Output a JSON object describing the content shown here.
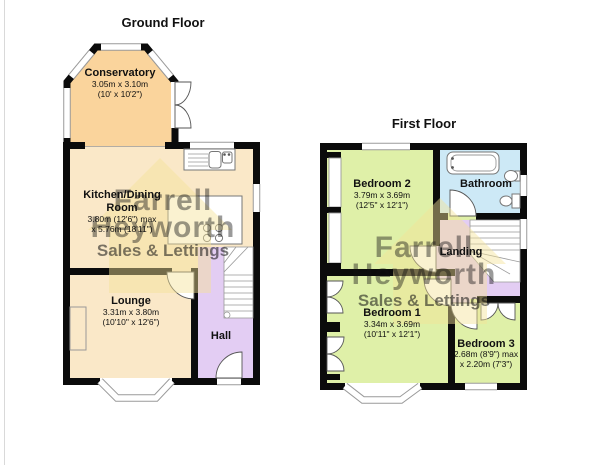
{
  "titles": {
    "ground": "Ground Floor",
    "first": "First Floor"
  },
  "watermark": {
    "name1": "Farrell",
    "name2": "Heyworth",
    "tagline": "Sales & Lettings"
  },
  "rooms": {
    "conservatory": {
      "name": "Conservatory",
      "dim_metric": "3.05m x 3.10m",
      "dim_imperial": "(10' x 10'2\")"
    },
    "kitchen": {
      "name_line1": "Kitchen/Dining",
      "name_line2": "Room",
      "dim_metric": "3.80m (12'6\") max",
      "dim_imperial": "x 5.76m (18'11\")"
    },
    "lounge": {
      "name": "Lounge",
      "dim_metric": "3.31m x 3.80m",
      "dim_imperial": "(10'10\" x 12'6\")"
    },
    "hall": {
      "name": "Hall"
    },
    "bedroom2": {
      "name": "Bedroom 2",
      "dim_metric": "3.79m x 3.69m",
      "dim_imperial": "(12'5\" x 12'1\")"
    },
    "bathroom": {
      "name": "Bathroom"
    },
    "landing": {
      "name": "Landing"
    },
    "bedroom1": {
      "name": "Bedroom 1",
      "dim_metric": "3.34m x 3.69m",
      "dim_imperial": "(10'11\" x 12'1\")"
    },
    "bedroom3": {
      "name": "Bedroom 3",
      "dim_metric": "2.68m (8'9\") max",
      "dim_imperial": "x 2.20m (7'3\")"
    }
  },
  "colors": {
    "conservatory": "#fad49c",
    "kitchen": "#fae8c8",
    "lounge": "#fae8c8",
    "hall": "#e3cdf3",
    "landing": "#e3cdf3",
    "bedroom": "#dff0a8",
    "bathroom": "#cde9f6",
    "wall": "#0b0b0b",
    "watermark_grey": "#8d988d",
    "watermark_orange": "#f49a00",
    "watermark_house": "#f3e397"
  }
}
